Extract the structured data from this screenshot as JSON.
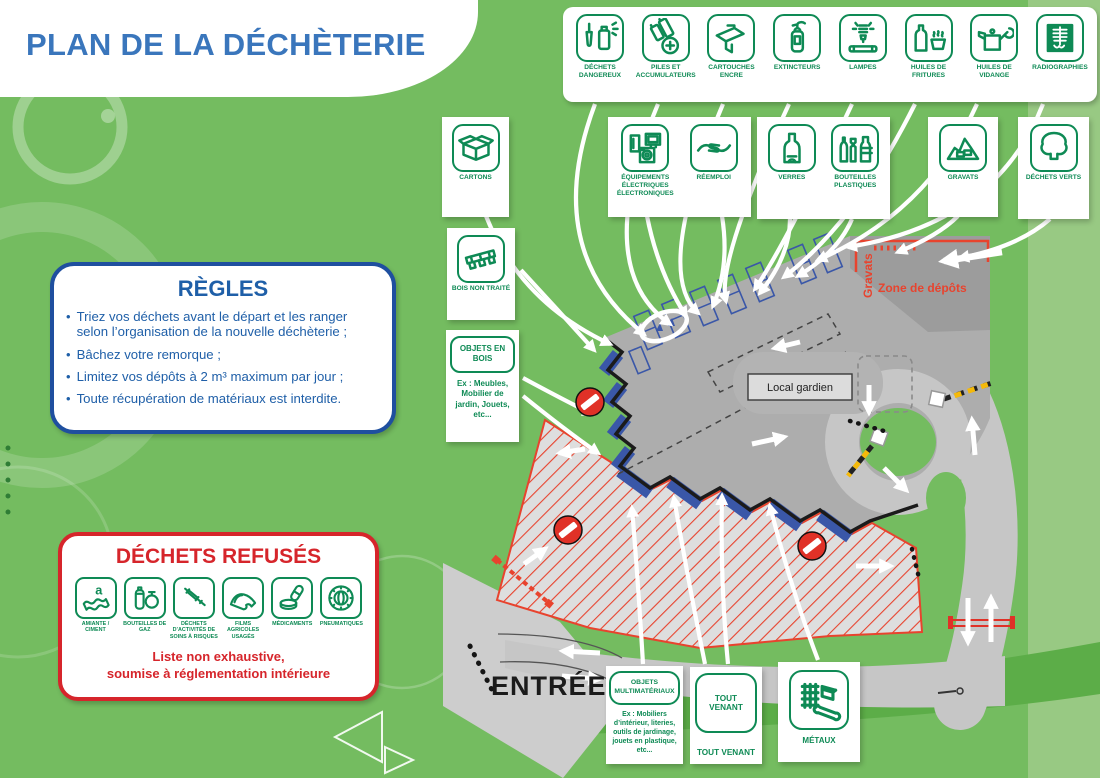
{
  "colors": {
    "background_green": "#74BC60",
    "side_band_green": "#98C983",
    "dark_band_green": "#5CAD48",
    "icon_green": "#0E8A55",
    "title_blue": "#3A76BC",
    "rules_border_blue": "#1F4F9F",
    "rules_text_blue": "#1F5FA8",
    "refused_red": "#D6252B",
    "map_red": "#E8432E",
    "bay_blue": "#3A57A8",
    "platform_gray": "#ADADAD",
    "road_gray": "#C6C6C6"
  },
  "title": "PLAN DE LA DÉCHÈTERIE",
  "top_strip": {
    "items": [
      {
        "icon": "dechets-dangereux",
        "label": "DÉCHETS DANGEREUX"
      },
      {
        "icon": "piles-accumulateurs",
        "label": "PILES ET ACCUMULATEURS"
      },
      {
        "icon": "cartouches-encre",
        "label": "CARTOUCHES ENCRE"
      },
      {
        "icon": "extincteurs",
        "label": "EXTINCTEURS"
      },
      {
        "icon": "lampes",
        "label": "LAMPES"
      },
      {
        "icon": "huiles-fritures",
        "label": "HUILES DE FRITURES"
      },
      {
        "icon": "huiles-vidange",
        "label": "HUILES DE VIDANGE"
      },
      {
        "icon": "radiographies",
        "label": "RADIOGRAPHIES"
      }
    ]
  },
  "cards": {
    "cartons": {
      "items": [
        {
          "icon": "cartons",
          "label": "CARTONS"
        }
      ]
    },
    "equip_reemploi": {
      "items": [
        {
          "icon": "equipements-electriques",
          "label": "ÉQUIPEMENTS ÉLECTRIQUES ÉLECTRONIQUES"
        },
        {
          "icon": "reemploi",
          "label": "RÉEMPLOI"
        }
      ]
    },
    "verres_bouteilles": {
      "items": [
        {
          "icon": "verres",
          "label": "VERRES"
        },
        {
          "icon": "bouteilles-plastiques",
          "label": "BOUTEILLES PLASTIQUES"
        }
      ]
    },
    "gravats": {
      "items": [
        {
          "icon": "gravats",
          "label": "GRAVATS"
        }
      ]
    },
    "dechets_verts": {
      "items": [
        {
          "icon": "dechets-verts",
          "label": "DÉCHETS VERTS"
        }
      ]
    },
    "bois_non_traite": {
      "items": [
        {
          "icon": "bois-non-traite",
          "label": "BOIS NON TRAITÉ"
        }
      ]
    },
    "objets_en_bois": {
      "title": "OBJETS EN BOIS",
      "example": "Ex : Meubles, Mobilier de jardin, Jouets, etc..."
    },
    "objets_multimateriaux": {
      "title": "OBJETS MULTIMATÉRIAUX",
      "example": "Ex : Mobiliers d’intérieur, literies, outils de jardinage, jouets en plastique, etc..."
    },
    "tout_venant": {
      "box_label": "TOUT VENANT",
      "label": "TOUT VENANT"
    },
    "metaux": {
      "items": [
        {
          "icon": "metaux",
          "label": "MÉTAUX"
        }
      ]
    }
  },
  "rules": {
    "title": "RÈGLES",
    "items": [
      "Triez vos déchets avant le départ et les ranger selon l’organisation de la nouvelle déchèterie ;",
      "Bâchez votre remorque ;",
      "Limitez vos dépôts à 2 m³ maximum par jour ;",
      "Toute récupération de matériaux est interdite."
    ]
  },
  "refused": {
    "title": "DÉCHETS REFUSÉS",
    "items": [
      {
        "icon": "amiante-ciment",
        "label": "AMIANTE / CIMENT"
      },
      {
        "icon": "bouteilles-de-gaz",
        "label": "BOUTEILLES DE GAZ"
      },
      {
        "icon": "dechets-soins-risques",
        "label": "DÉCHETS D’ACTIVITÉS DE SOINS À RISQUES"
      },
      {
        "icon": "films-agricoles",
        "label": "FILMS AGRICOLES USAGÉS"
      },
      {
        "icon": "medicaments",
        "label": "MÉDICAMENTS"
      },
      {
        "icon": "pneumatiques",
        "label": "PNEUMATIQUES"
      }
    ],
    "note_lines": [
      "Liste non exhaustive,",
      "soumise à réglementation intérieure"
    ]
  },
  "map": {
    "entrance_label": "ENTRÉE",
    "gravats_label": "Gravats",
    "zone_depots_label": "Zone de dépôts",
    "local_gardien_label": "Local gardien"
  }
}
